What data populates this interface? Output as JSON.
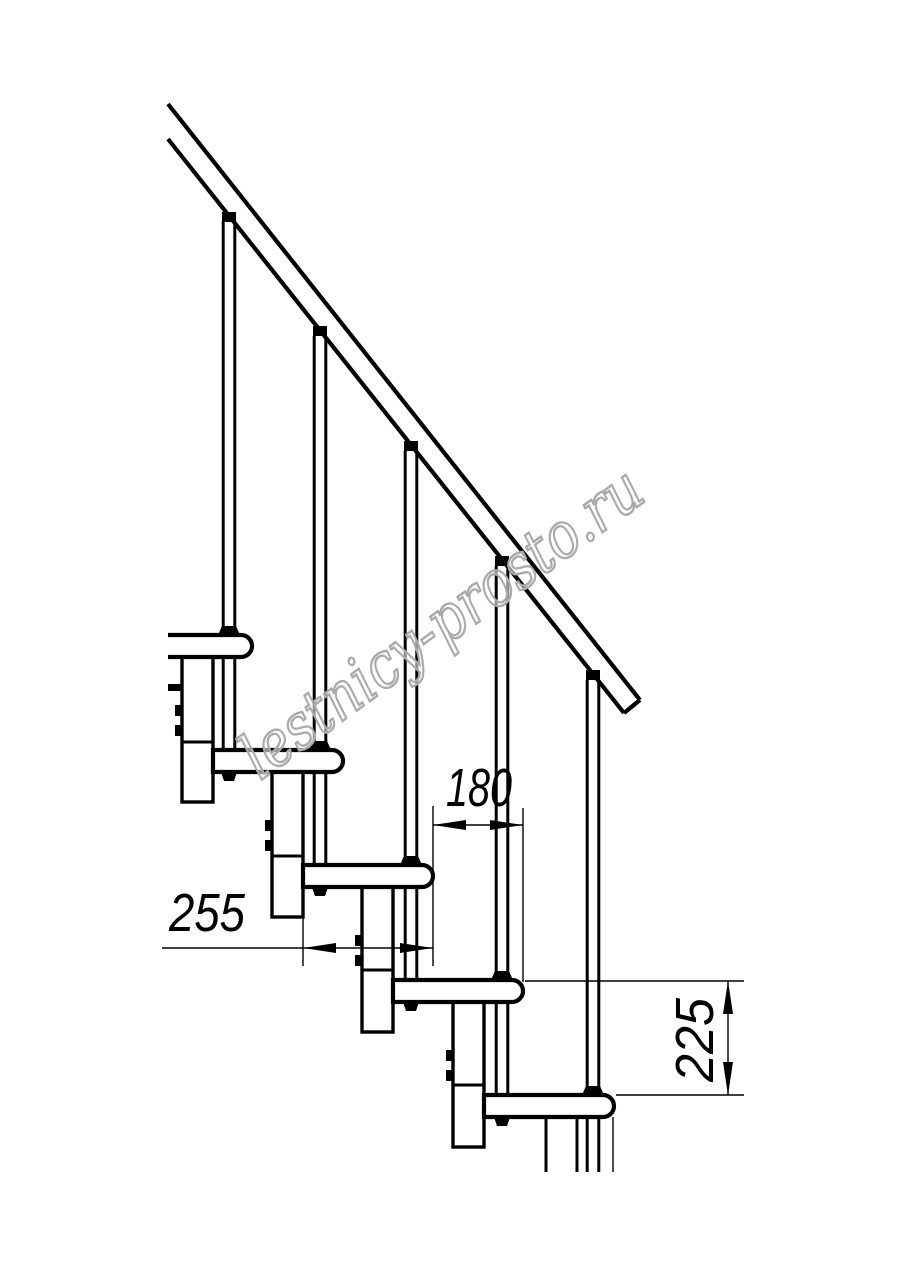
{
  "drawing": {
    "type": "technical-line-drawing",
    "subject": "modular staircase side elevation",
    "treads_visible": 5,
    "balusters_visible": 5,
    "support_modules_visible": 5,
    "line_color": "#000000",
    "background_color": "#ffffff"
  },
  "dimensions": {
    "d180": "180",
    "d255": "255",
    "d225": "225"
  },
  "watermark": {
    "text": "lestnicy-prosto.ru",
    "color": "#aaaaaa"
  }
}
